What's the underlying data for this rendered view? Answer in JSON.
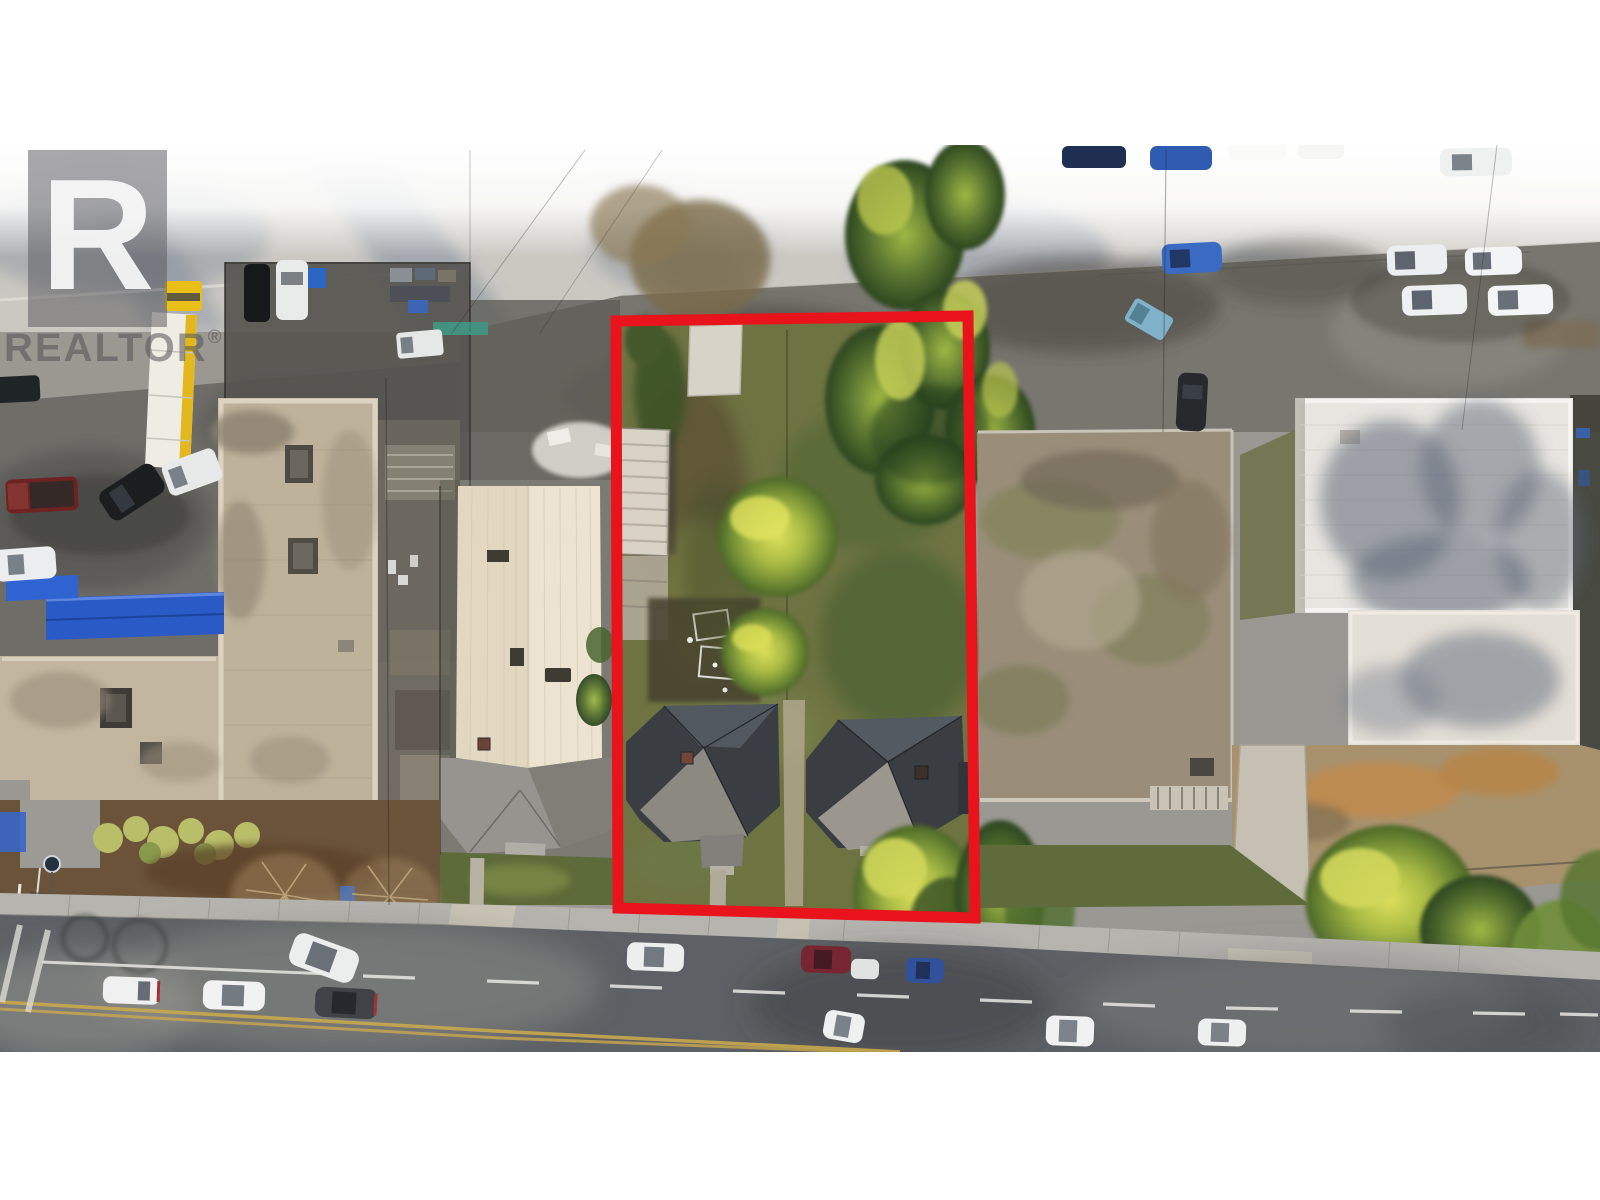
{
  "watermark": {
    "logo_letter": "R",
    "brand": "REALTOR",
    "registered_symbol": "®"
  },
  "annotation": {
    "boundary_color": "#e8131b"
  },
  "photo": {
    "type": "aerial-drone-photo-of-property",
    "palette": {
      "top_road": "#cbc8c2",
      "alley_asphalt": "#77766f",
      "bottom_road": "#5d6064",
      "grass_olive": "#6e7342",
      "tree_bright": "#d3d64f",
      "tree_dark": "#42602c",
      "roof_dark_shingle": "#3a3e42",
      "roof_cream_metal": "#ece4d0",
      "roof_tan_flat": "#bfb29b",
      "roof_white_flat": "#e8e6e0",
      "awning_blue": "#2a5ac6",
      "truck_yellow": "#e9bf17",
      "lane_yellow": "#c9a84e",
      "sidewalk": "#b6b4af"
    }
  }
}
